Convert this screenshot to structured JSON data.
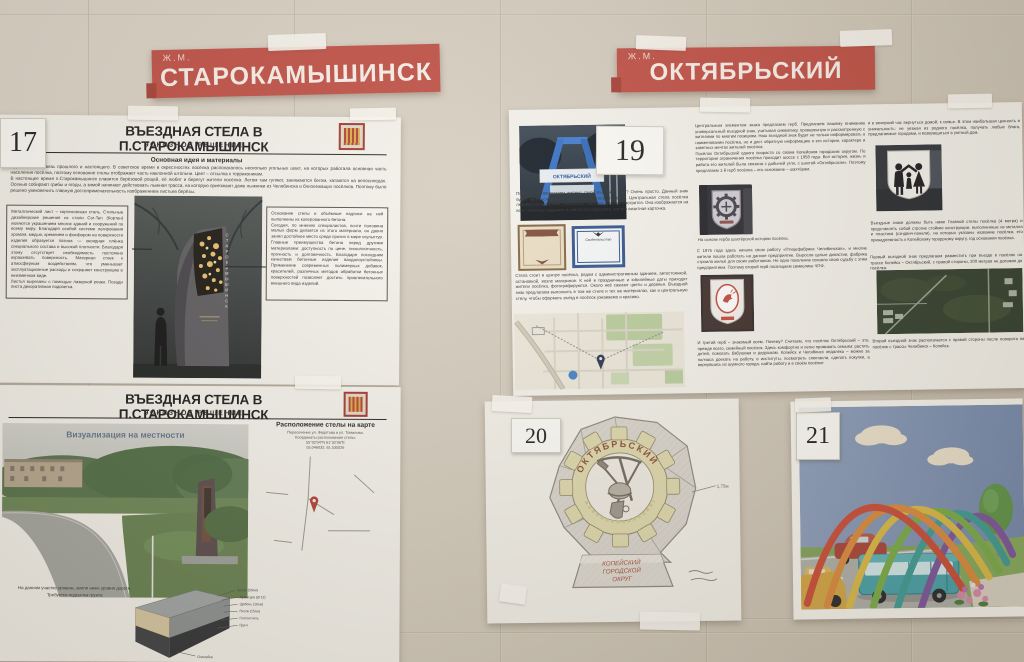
{
  "colors": {
    "wall": "#d2cabc",
    "banner_red": "#bd4a40",
    "poster_paper": "#f3f1eb"
  },
  "banners": {
    "left": {
      "prefix": "Ж.М.",
      "title": "СТАРОКАМЫШИНСК"
    },
    "right": {
      "prefix": "Ж.М.",
      "title": "ОКТЯБРЬСКИЙ"
    }
  },
  "poster17_top": {
    "tag": "17",
    "title": "ВЪЕЗДНАЯ СТЕЛА В П.СТАРОКАМЫШИНСК",
    "subtitle": "ЭСКИЗНОЕ РЕШЕНИЕ",
    "section_heading": "Основная идея и материалы",
    "intro": "Идея стелы – связь прошлого и настоящего. В советское время в окрестностях посёлка располагалось несколько угольных шахт, на которых работала основная часть населения посёлка, поэтому основание стелы отображает часть наклонной штольни. Цвет – отсылка к терриконикам.\nВ настоящее время п.Старокамышинск славится берёзовой рощей, её любят и берегут жители посёлка. Летом там гуляют, занимаются бегом, катаются на велосипедах. Осенью собирают грибы и ягоды, а зимой начинает действовать лыжная трасса, на которую приезжают даже лыжники из Челябинска и близлежащих посёлков. Поэтому было решено увековечить главную достопримечательность изображением листьев берёзы.",
    "left_note": "Металлический лист – кортеновская сталь. Стильные дизайнерские решения из стали Cor-Ten (Кортен) являются украшением многих зданий и сооружений по всему миру. Благодаря особой системе легирования хромом, медью, кремнием и фосфором на поверхности изделия образуется патина — оксидная плёнка специального состава и высокой плотности. Благодаря этому отсутствует необходимость постоянно окрашивать поверхность. Материал стоек к атмосферным воздействиям, что уменьшает эксплуатационные расходы и сохраняет конструкцию в неизменном виде.\nЛистья вырезаны с помощью лазерной резки. Позади листа декоративная подсветка.",
    "right_note": "Основание стелы и объёмные надписи на ней выполнены из колерованного бетона.\nСегодня, по мнению специалистов, почти половина малых форм делается из этого материала, он давно занял достойное место среди прочих в мире скульптур. Главные преимущества бетона перед другими материалами: доступность по цене, технологичность, прочность и долговечность. Благодаря последним качествам бетонные изделия вандалоустойчивы. Применение современных полимерных добавок, красителей, различных методов обработки бетонных поверхностей позволяет достичь привлекательного внешнего вида изделий.",
    "stela_vertical_text": "СТАРОКАМЫШИНСК"
  },
  "poster17_bottom": {
    "title": "ВЪЕЗДНАЯ СТЕЛА В П.СТАРОКАМЫШИНСК",
    "subtitle": "ЭСКИЗНОЕ РЕШЕНИЕ",
    "viz_caption": "Визуализация на местности",
    "map_title": "Расположение стелы на карте",
    "map_lines": [
      "Пересечение ул. Федотова и ул. Томилова.",
      "Координаты расположения стелы:",
      "55°02'04\"N  61°32'06\"E",
      "55.046032, 61.535026"
    ],
    "ground_note_1": "На данном участке уровень земли ниже уровня дороги.",
    "ground_note_2": "Требуется подсыпка грунта",
    "layer_labels": [
      "Бетон (50см)",
      "Арматура (Ø 12)",
      "Щебень (10см)",
      "Песок (15см)",
      "Геотекстиль",
      "Грунт",
      "Опалубка"
    ]
  },
  "poster19": {
    "tag": "19",
    "photo_sign_text": "ОКТЯБРЬСКИЙ",
    "col1_p1": "Почему мы предлагаем именно такой въездной знак? Очень просто. Данный знак будет являться копией центральной стелы посёлка. Центральная стела посёлка любима его жителями, узнаваема, шикарно красиво смотрится. Она изображается на всех печатных изданиях и сайтах Октябрьского, как его визитная карточка.",
    "cert2_title": "Свидетельство",
    "col1_p2": "Стела стоит в центре посёлка, рядом с административным зданием, автостоянкой, остановкой, возле магазинов. К ней в праздничные и юбилейные даты приходят жители посёлка, фотографируются. Около неё сажают цветы и деревья. Въездной знак предлагаем выполнить в том же стиле и тех же материалах, как и центральную стелу, чтобы оформить въезд в посёлок узнаваемо и красиво.",
    "col2_p1": "Центральным элементом знака предлагаем герб. Предлагаем вашему вниманию универсальный въездной знак, учитывая символику, проверенную и рассмотренную с жителями по многим позициям. Наш въездной знак будет не только информировать о наименовании посёлка, но и даст обратную информацию о его истории, характере и заветных мечтах жителей посёлка.\nПосёлок Октябрьский одного возраста со своим Копейским городским округом. По территории ограничения посёлка проходит шоссе с 1958 года. Вся история, жизнь и работа его жителей была связана с добычей угля, с шахтой «Октябрьская». Поэтому предлагаем 1-й герб посёлка – его основание – шахтёрам.",
    "col2_caption": "На основе герба шахтёрской истории посёлка.",
    "col2_p2": "С 1975 года здесь начала свою работу «Птицефабрика Челябинская», и многие жители пошли работать на данное предприятие. Выросли целые династии, фабрика строила жильё для своих работников. Не одно поколение связало свою судьбу с этим предприятием. Поэтому второй герб посвящаем символике ЧПФ.",
    "col2_p3": "И третий герб – знакомый всем. Почему? Считаем, что посёлок Октябрьский – это, прежде всего, семейный посёлок. Здесь комфортно и легко проживать семьям: растить детей, помогать бабушкам и дедушкам. Копейск и Челябинск недалеко – можно за полчаса доехать на работу, в институты, посмотреть спектакли, сделать покупки, а вернувшись из шумного города, найти работу и в своём посёлке",
    "col3_p1": "и в вечерний час вернуться домой, к семье. В этом наибольшая ценность и уникальность: не уезжая из родного посёлка, получать любые блага, предлагаемые городами, и возвращаться в уютный дом.",
    "col3_p2": "Въездные знаки должны быть ниже Главной стелы посёлка (4 метра) и представлять собой строгие стойкие конструкции, выполненные из металла и пластика (сэндвич-панели), на которых указаны название посёлка, его принадлежность к Копейскому городскому округу, год основания посёлка.",
    "col3_p3": "Первый въездной знак предлагаем разместить при въезде в посёлок на трассе Копейск – Октябрьский, с правой стороны, 200 метров не доезжая до посёлка.",
    "col3_p4": "Второй въездной знак располагается с правой стороны после поворота на посёлок с трассы Челябинск – Копейск."
  },
  "poster20": {
    "tag": "20",
    "arc_text": "ОКТЯБРЬСКИЙ",
    "pedestal_lines": [
      "КОПЕЙСКИЙ",
      "ГОРОДСКОЙ",
      "ОКРУГ"
    ],
    "height_note": "1,75м"
  },
  "poster21": {
    "tag": "21"
  }
}
